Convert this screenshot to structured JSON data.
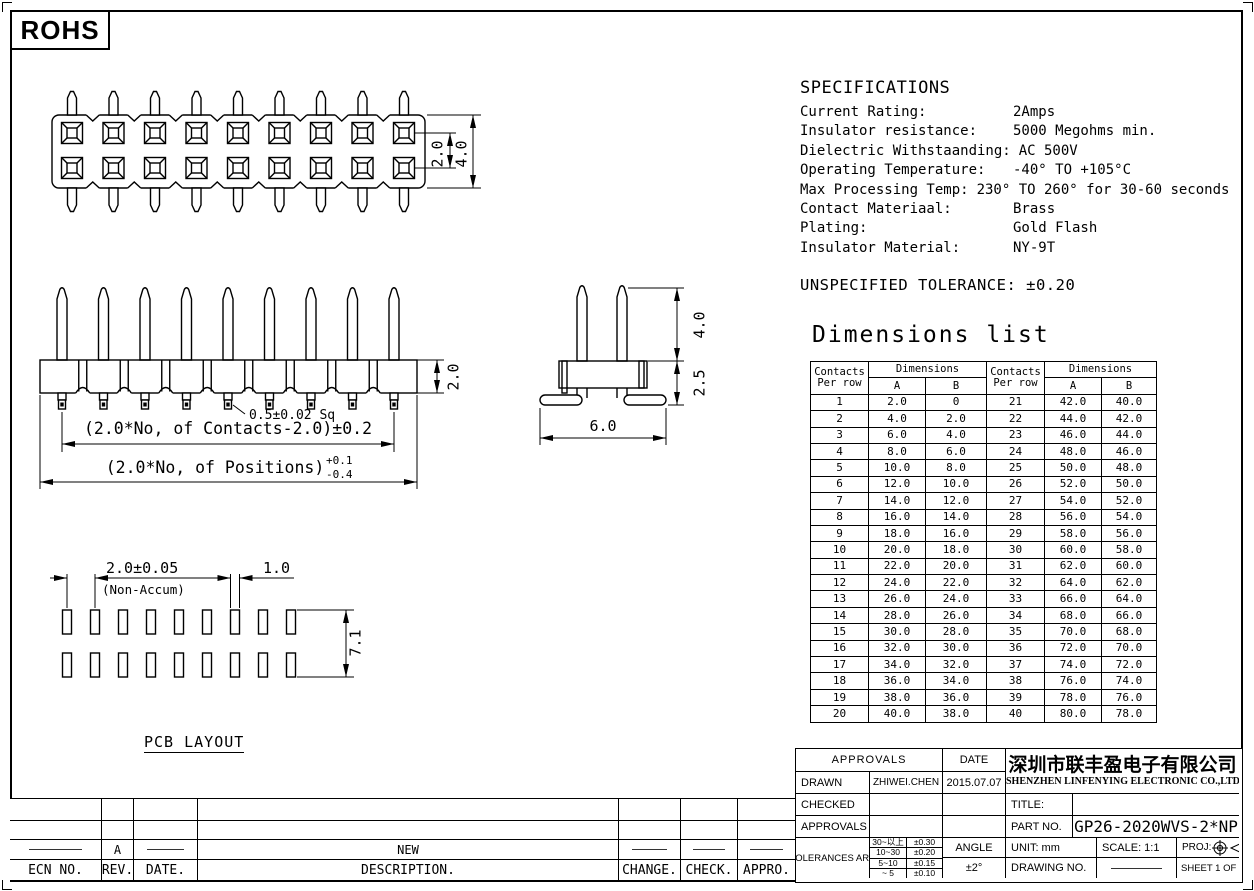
{
  "sheet": {
    "rohs_label": "ROHS"
  },
  "specifications": {
    "title": "SPECIFICATIONS",
    "rows": [
      {
        "label": "Current Rating:",
        "value": "2Amps"
      },
      {
        "label": "Insulator resistance:",
        "value": "5000 Megohms min."
      },
      {
        "label": "Dielectric Withstaanding:",
        "value": "AC 500V"
      },
      {
        "label": "Operating Temperature:",
        "value": "-40° TO +105°C"
      },
      {
        "label": "Max Processing Temp:",
        "value": "230° TO 260° for 30-60 seconds"
      },
      {
        "label": "Contact Materiaal:",
        "value": "Brass"
      },
      {
        "label": "Plating:",
        "value": "Gold  Flash"
      },
      {
        "label": "Insulator Material:",
        "value": "NY-9T"
      }
    ]
  },
  "unspecified_tolerance": "UNSPECIFIED TOLERANCE: ±0.20",
  "dimensions_list": {
    "title": "Dimensions list",
    "headers": {
      "contacts_line1": "Contacts",
      "contacts_line2": "Per row",
      "dimensions": "Dimensions",
      "a": "A",
      "b": "B"
    },
    "left_rows": [
      [
        "1",
        "2.0",
        "0"
      ],
      [
        "2",
        "4.0",
        "2.0"
      ],
      [
        "3",
        "6.0",
        "4.0"
      ],
      [
        "4",
        "8.0",
        "6.0"
      ],
      [
        "5",
        "10.0",
        "8.0"
      ],
      [
        "6",
        "12.0",
        "10.0"
      ],
      [
        "7",
        "14.0",
        "12.0"
      ],
      [
        "8",
        "16.0",
        "14.0"
      ],
      [
        "9",
        "18.0",
        "16.0"
      ],
      [
        "10",
        "20.0",
        "18.0"
      ],
      [
        "11",
        "22.0",
        "20.0"
      ],
      [
        "12",
        "24.0",
        "22.0"
      ],
      [
        "13",
        "26.0",
        "24.0"
      ],
      [
        "14",
        "28.0",
        "26.0"
      ],
      [
        "15",
        "30.0",
        "28.0"
      ],
      [
        "16",
        "32.0",
        "30.0"
      ],
      [
        "17",
        "34.0",
        "32.0"
      ],
      [
        "18",
        "36.0",
        "34.0"
      ],
      [
        "19",
        "38.0",
        "36.0"
      ],
      [
        "20",
        "40.0",
        "38.0"
      ]
    ],
    "right_rows": [
      [
        "21",
        "42.0",
        "40.0"
      ],
      [
        "22",
        "44.0",
        "42.0"
      ],
      [
        "23",
        "46.0",
        "44.0"
      ],
      [
        "24",
        "48.0",
        "46.0"
      ],
      [
        "25",
        "50.0",
        "48.0"
      ],
      [
        "26",
        "52.0",
        "50.0"
      ],
      [
        "27",
        "54.0",
        "52.0"
      ],
      [
        "28",
        "56.0",
        "54.0"
      ],
      [
        "29",
        "58.0",
        "56.0"
      ],
      [
        "30",
        "60.0",
        "58.0"
      ],
      [
        "31",
        "62.0",
        "60.0"
      ],
      [
        "32",
        "64.0",
        "62.0"
      ],
      [
        "33",
        "66.0",
        "64.0"
      ],
      [
        "34",
        "68.0",
        "66.0"
      ],
      [
        "35",
        "70.0",
        "68.0"
      ],
      [
        "36",
        "72.0",
        "70.0"
      ],
      [
        "37",
        "74.0",
        "72.0"
      ],
      [
        "38",
        "76.0",
        "74.0"
      ],
      [
        "39",
        "78.0",
        "76.0"
      ],
      [
        "40",
        "80.0",
        "78.0"
      ]
    ]
  },
  "views": {
    "top_view": {
      "dim_row_pitch": "2.0",
      "dim_overall_width": "4.0"
    },
    "front_view": {
      "dim_body_height": "2.0",
      "pin_square": "0.5±0.02 Sq",
      "dim_contacts_span": "(2.0*No, of Contacts-2.0)±0.2",
      "dim_positions_span": "(2.0*No, of Positions)",
      "positions_tol_plus": "+0.1",
      "positions_tol_minus": "-0.4"
    },
    "side_view": {
      "dim_pin_height": "4.0",
      "dim_body_depth": "2.5",
      "dim_foot_span": "6.0"
    },
    "pcb_layout": {
      "label": "PCB LAYOUT",
      "dim_pitch": "2.0±0.05",
      "dim_pitch_note": "(Non-Accum)",
      "dim_pad_width": "1.0",
      "dim_row_span": "7.1"
    }
  },
  "title_block": {
    "approvals_header": "APPROVALS",
    "date_header": "DATE",
    "drawn_label": "DRAWN",
    "drawn_by": "ZHIWEI.CHEN",
    "drawn_date": "2015.07.07",
    "checked_label": "CHECKED",
    "approvals_label": "APPROVALS",
    "tolerances_label": "TOLERANCES ARE",
    "tolerance_rows": [
      [
        "30~以上",
        "±0.30"
      ],
      [
        "10~30",
        "±0.20"
      ],
      [
        "5~10",
        "±0.15"
      ],
      [
        "~ 5",
        "±0.10"
      ]
    ],
    "angle_label": "ANGLE",
    "angle_value": "±2°",
    "company_cn": "深圳市联丰盈电子有限公司",
    "company_en": "SHENZHEN LINFENYING ELECTRONIC CO.,LTD",
    "title_label": "TITLE:",
    "title_value": "",
    "part_no_label": "PART  NO.",
    "part_no_value": "GP26-2020WVS-2*NP",
    "unit_label": "UNIT:  mm",
    "scale_label": "SCALE:   1:1",
    "proj_label": "PROJ:",
    "drawing_no_label": "DRAWING  NO.",
    "drawing_no_value": "",
    "sheet_label": "SHEET  1 OF 1"
  },
  "revision_table": {
    "headers": [
      "ECN  NO.",
      "REV.",
      "DATE.",
      "DESCRIPTION.",
      "CHANGE.",
      "CHECK.",
      "APPRO."
    ],
    "rows": [
      [
        "",
        "",
        "",
        "",
        "",
        "",
        ""
      ],
      [
        "",
        "",
        "",
        "",
        "",
        "",
        ""
      ],
      [
        "—",
        "A",
        "—",
        "NEW",
        "—",
        "—",
        "—"
      ]
    ]
  }
}
